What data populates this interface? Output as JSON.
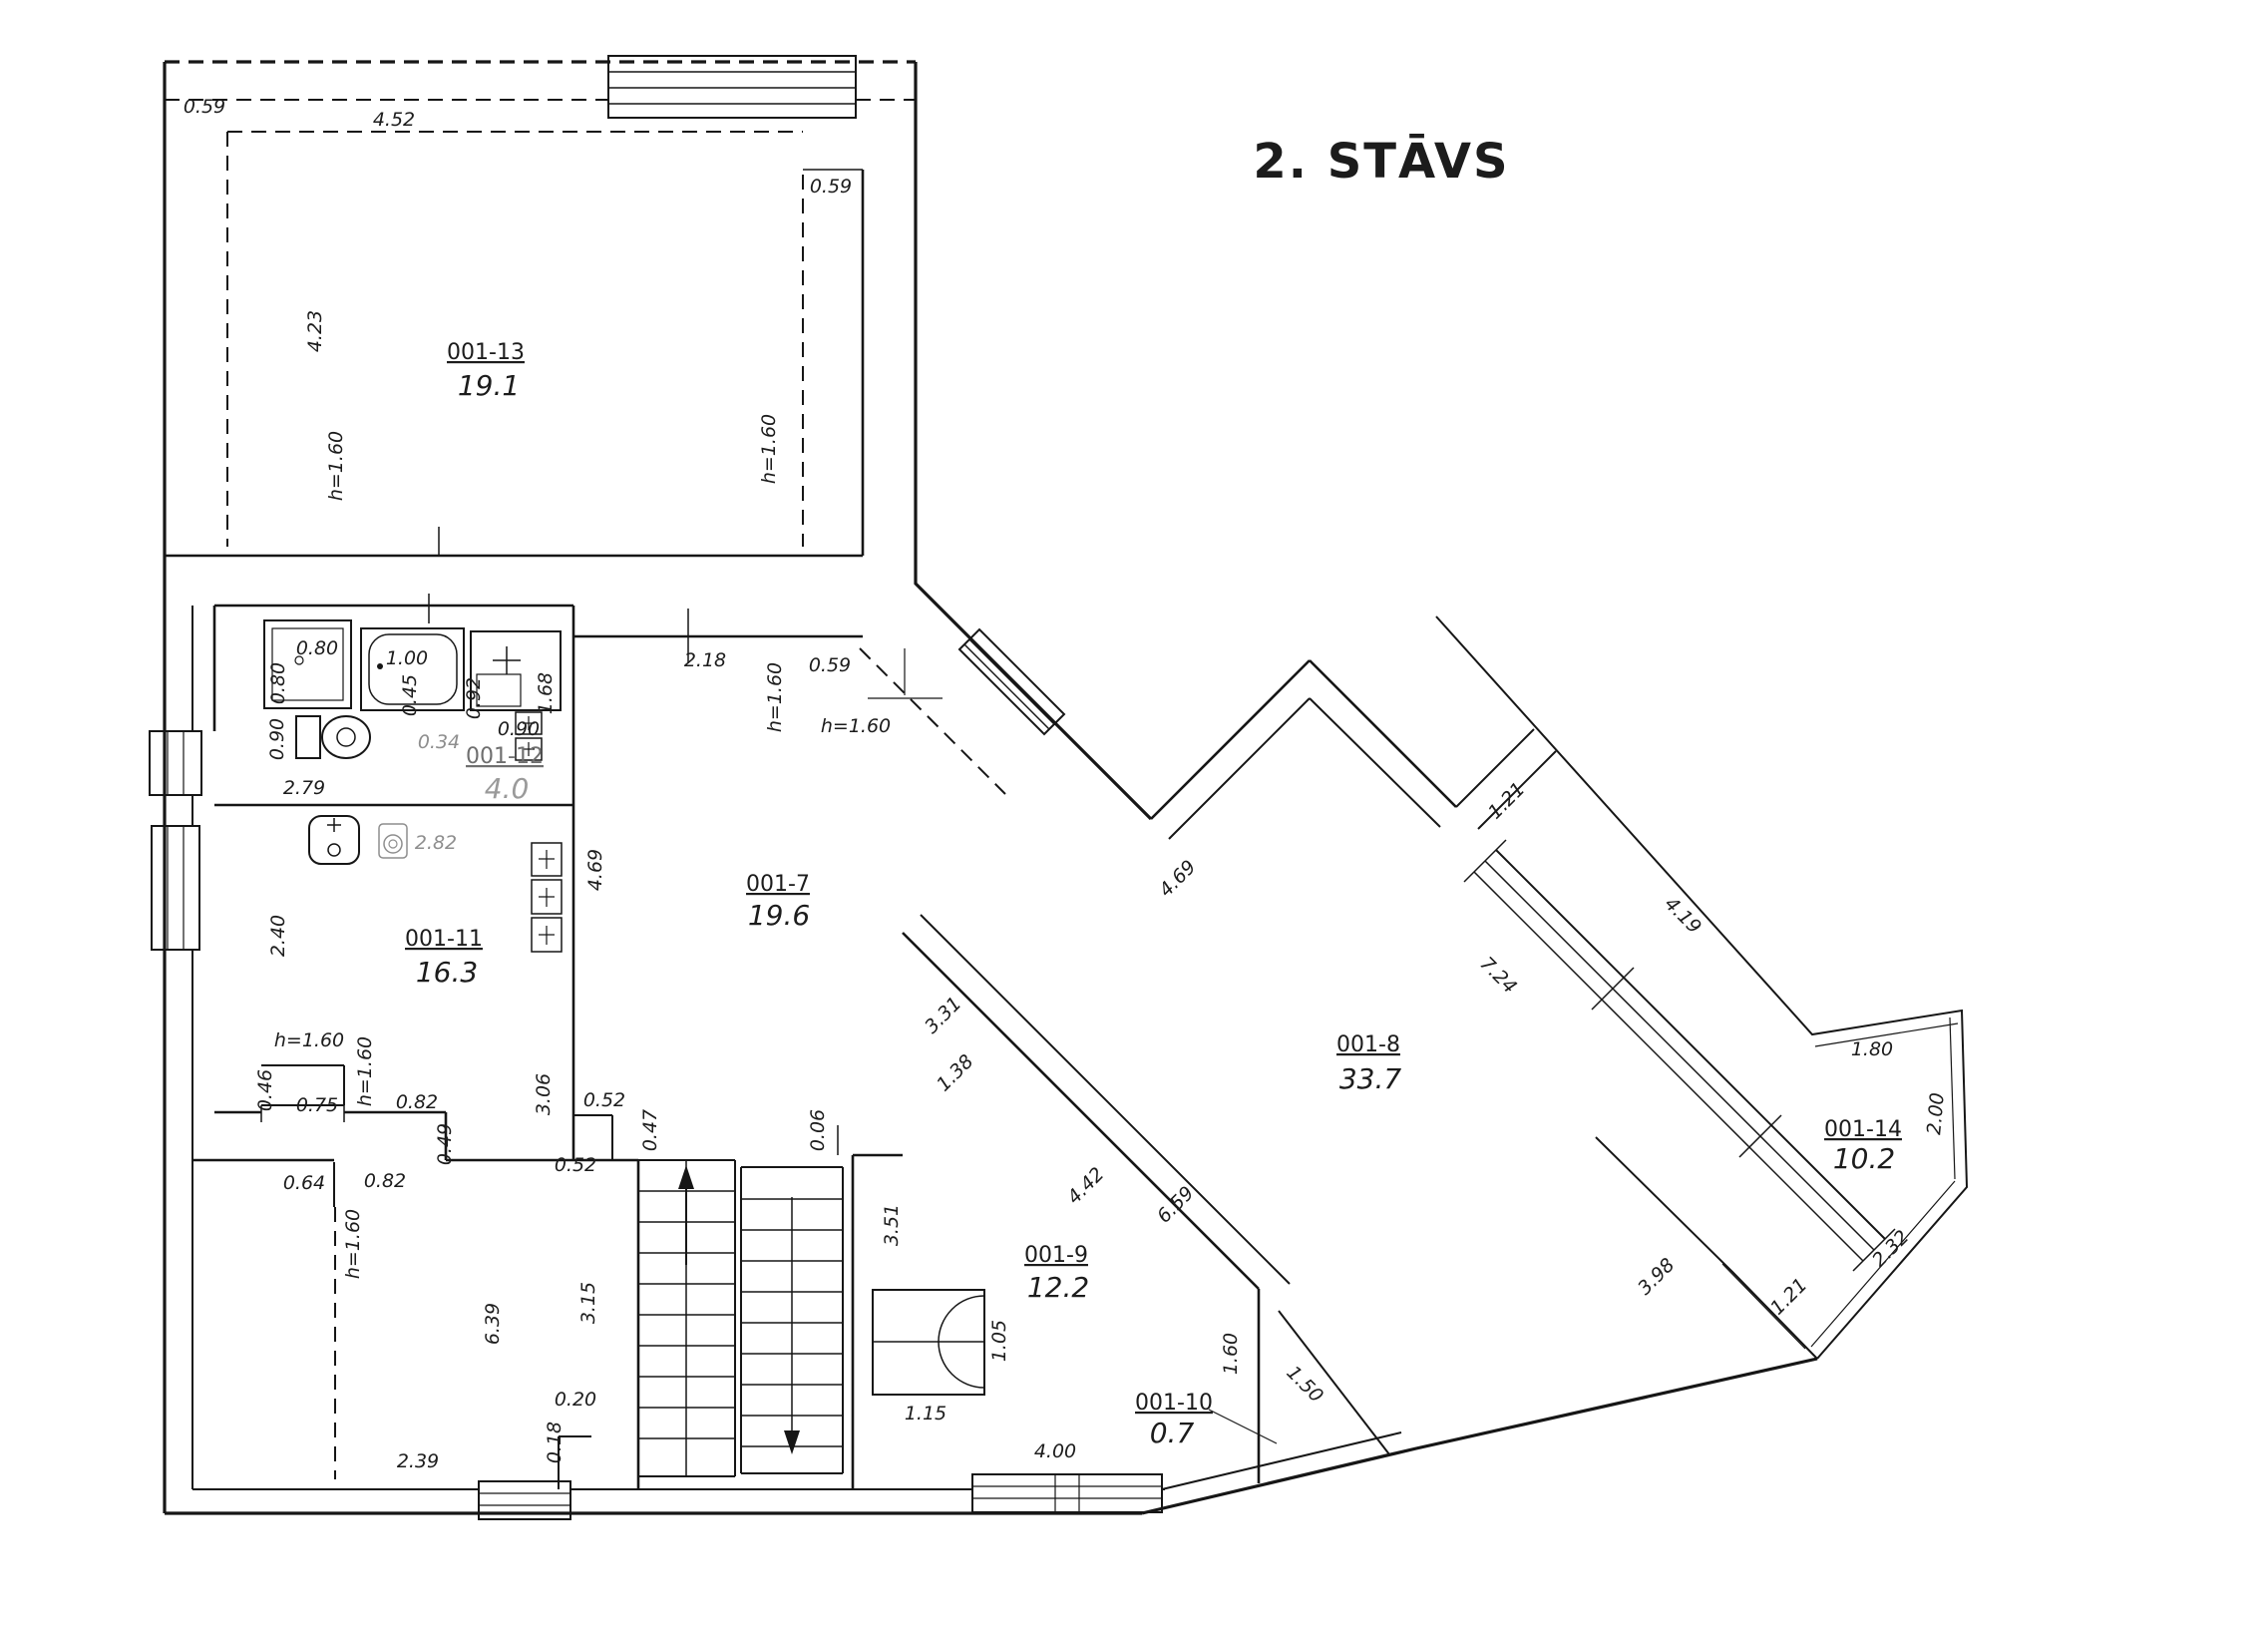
{
  "title": {
    "text": "2. STĀVS",
    "color": "#cf1b22"
  },
  "rooms": [
    {
      "id": "001-13",
      "area": "19.1"
    },
    {
      "id": "001-12",
      "area": "4.0"
    },
    {
      "id": "001-11",
      "area": "16.3"
    },
    {
      "id": "001-7",
      "area": "19.6"
    },
    {
      "id": "001-8",
      "area": "33.7"
    },
    {
      "id": "001-9",
      "area": "12.2"
    },
    {
      "id": "001-10",
      "area": "0.7"
    },
    {
      "id": "001-14",
      "area": "10.2"
    }
  ],
  "d": {
    "r13_059L": "0.59",
    "r13_452": "4.52",
    "r13_059R": "0.59",
    "r13_423": "4.23",
    "r13_h1": "h=1.60",
    "r13_h2": "h=1.60",
    "b_080a": "0.80",
    "b_080b": "0.80",
    "b_100": "1.00",
    "b_045": "0.45",
    "b_092": "0.92",
    "b_168": "1.68",
    "b_090a": "0.90",
    "b_034": "0.34",
    "b_090b": "0.90",
    "b_279": "2.79",
    "r11_282": "2.82",
    "r11_240": "2.40",
    "r11_h1": "h=1.60",
    "r11_h2": "h=1.60",
    "r11_046": "0.46",
    "r11_075": "0.75",
    "r11_082": "0.82",
    "r11_049": "0.49",
    "r11_306": "3.06",
    "r7_052a": "0.52",
    "r7_052b": "0.52",
    "r7_047": "0.47",
    "r7_218": "2.18",
    "r7_059": "0.59",
    "r7_h1": "h=1.60",
    "r7_h2": "h=1.60",
    "r7_469": "4.69",
    "r7_006": "0.06",
    "r7_331": "3.31",
    "r7_138": "1.38",
    "bl_064": "0.64",
    "bl_082": "0.82",
    "bl_h1": "h=1.60",
    "bl_639": "6.39",
    "bl_315": "3.15",
    "bl_020": "0.20",
    "bl_018": "0.18",
    "bl_239": "2.39",
    "st_351": "3.51",
    "r9_105": "1.05",
    "r9_115": "1.15",
    "r9_400": "4.00",
    "r9_442": "4.42",
    "r9_659": "6.59",
    "r10_160": "1.60",
    "r10_150": "1.50",
    "r8_469": "4.69",
    "r8_121": "1.21",
    "r8_724": "7.24",
    "r14_419": "4.19",
    "r14_180": "1.80",
    "r14_200": "2.00",
    "r14_232": "2.32",
    "r14_121b": "1.21",
    "r14_398": "3.98"
  }
}
